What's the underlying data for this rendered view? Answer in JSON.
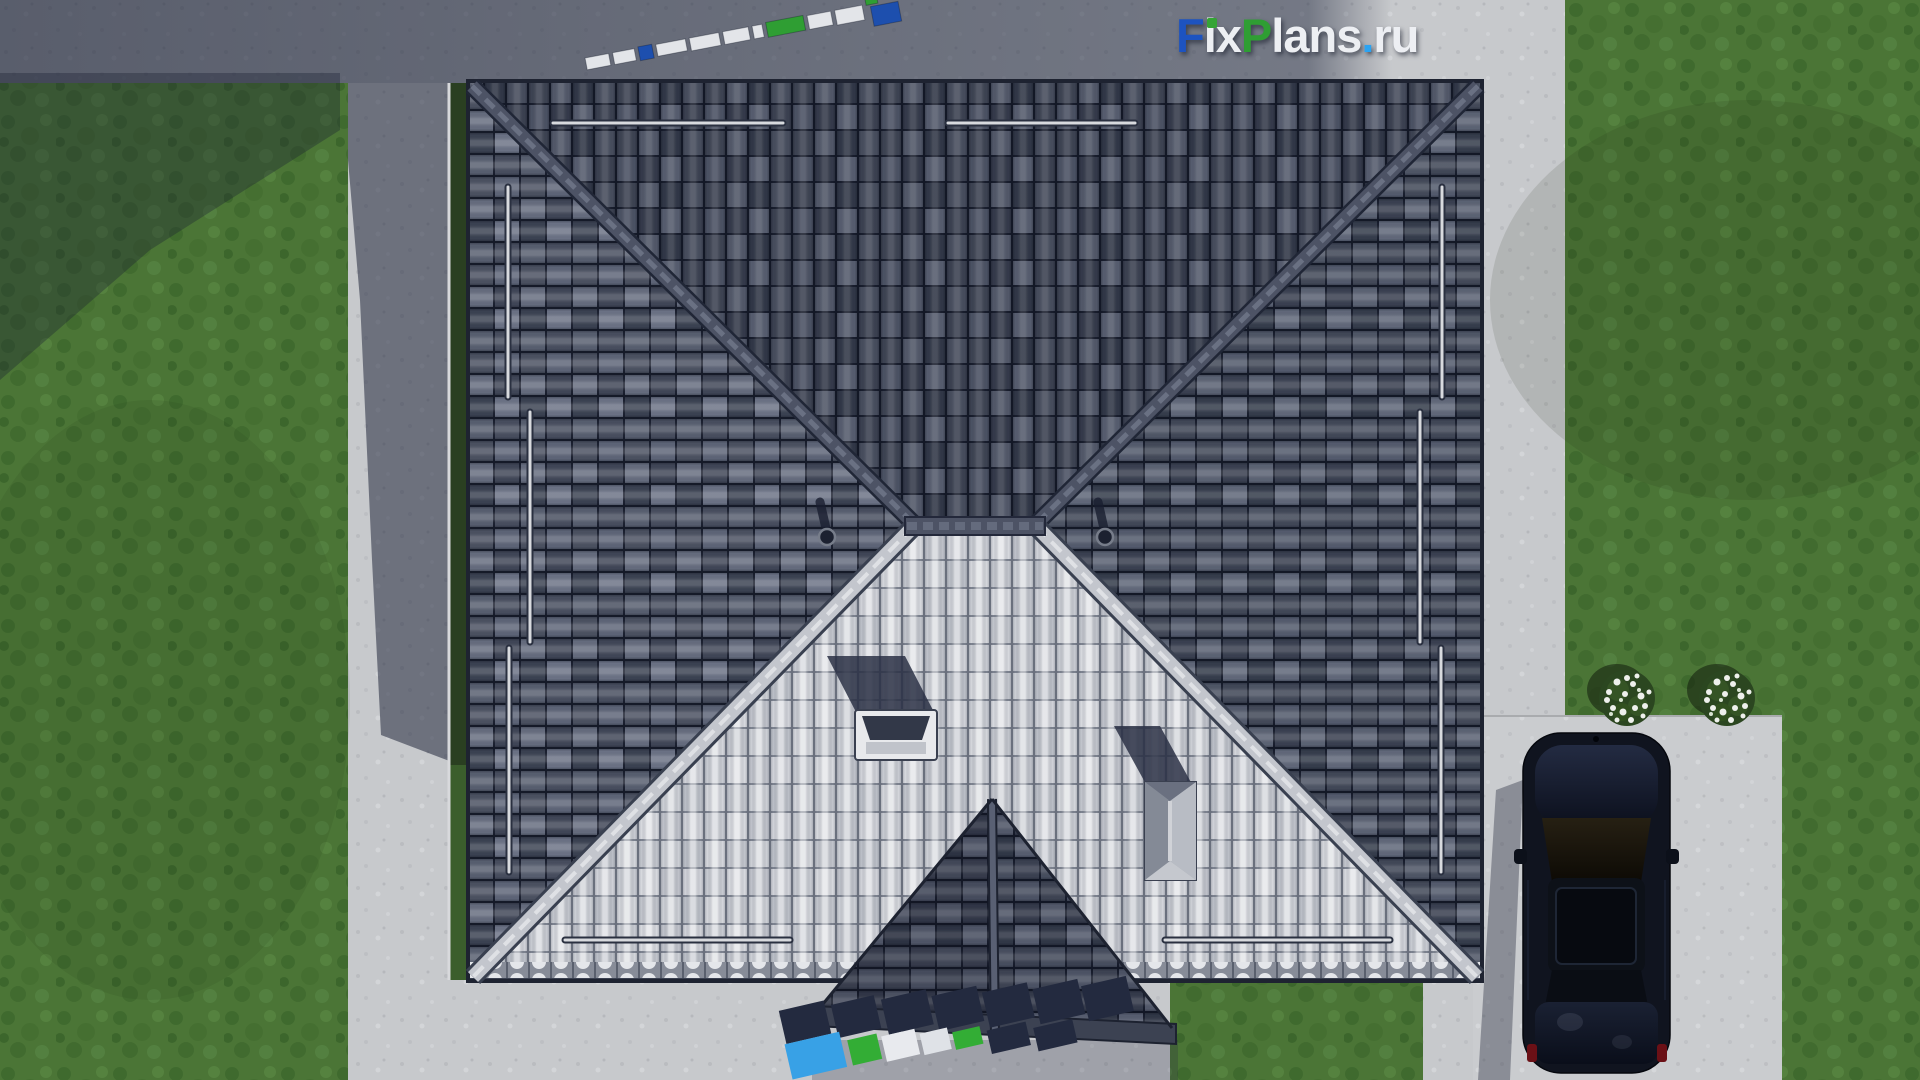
{
  "watermark": {
    "full_text": "FixPlans.ru",
    "parts": [
      {
        "text": "F",
        "color": "#1d53c0"
      },
      {
        "text": "ix",
        "color": "#edeff3"
      },
      {
        "text": "P",
        "color": "#2f9e33"
      },
      {
        "text": "lans",
        "color": "#edeff3"
      },
      {
        "text": ".",
        "color": "#2ba3f2"
      },
      {
        "text": "ru",
        "color": "#edeff3"
      }
    ],
    "i_dot_color": "#35a435",
    "ground_text_top": "FixPlans.ru",
    "ground_text_bottom": "FixPlans.ru"
  },
  "scene": {
    "view": "top-down 3D render of a hip-roof house",
    "colors": {
      "grass": "#4b7536",
      "concrete": "#c7c9cc",
      "concrete_shadow": "#4e5466",
      "roof_dark_tile": "#454b5c",
      "roof_light_tile": "#c9ccd3",
      "ridge_light": "#c3c6cd",
      "ridge_dark": "#4d5365",
      "porch_tile": "#3c4252",
      "car_body": "#10141f",
      "car_taillight": "#6b1016",
      "bush_foliage": "#2b4620",
      "bush_flowers": "#eef0ec"
    },
    "objects": {
      "roof_faces": 4,
      "snow_guard_rails": 10,
      "roof_vents": 2,
      "skylights": 1,
      "chimneys": 1,
      "porch_roofs": 1,
      "cars": 1,
      "flower_bushes": 2
    }
  }
}
